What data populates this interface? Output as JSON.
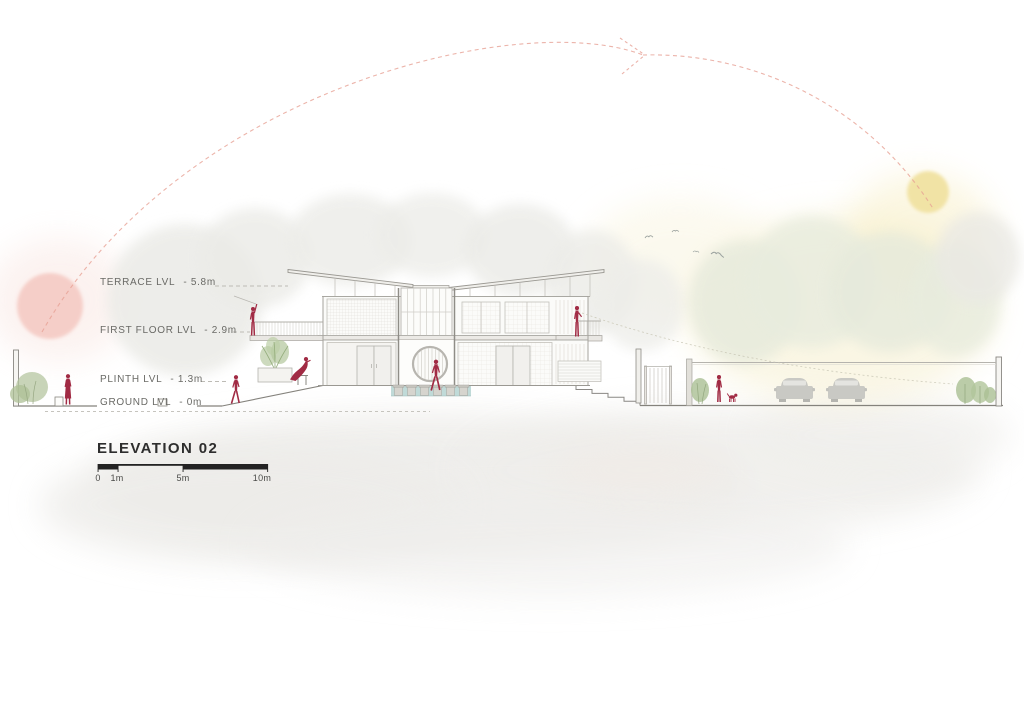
{
  "meta": {
    "title": "ELEVATION 02"
  },
  "levels": [
    {
      "name": "TERRACE LVL",
      "value": "- 5.8m"
    },
    {
      "name": "FIRST FLOOR LVL",
      "value": "- 2.9m"
    },
    {
      "name": "PLINTH LVL",
      "value": "- 1.3m"
    },
    {
      "name": "GROUND LVL",
      "value": "- 0m"
    }
  ],
  "scale_bar": {
    "ticks": [
      "0",
      "1m",
      "5m",
      "10m"
    ]
  },
  "colors": {
    "figure": "#A12B44",
    "sun": "#F1E2A2",
    "dawn_circle": "#F5CBC4",
    "sun_path": "#E7A195",
    "water": "#B9D6D4",
    "foliage": "#AEC29A",
    "car": "#C9C9C4",
    "line_dark": "#84827C",
    "line_light": "#B5B3AD",
    "wash_gray": "#EDECE9",
    "label_text": "#6A6A66",
    "title_text": "#2E2E2E"
  },
  "icons": {
    "sun-icon": "soft yellow circle",
    "dawn-circle-icon": "soft pink circle",
    "sun-path-icon": "dashed arc with arrow",
    "bird-icon": "stroked wing glyph",
    "person-icon": "crimson silhouette",
    "dog-icon": "crimson silhouette",
    "car-icon": "gray front silhouette"
  }
}
